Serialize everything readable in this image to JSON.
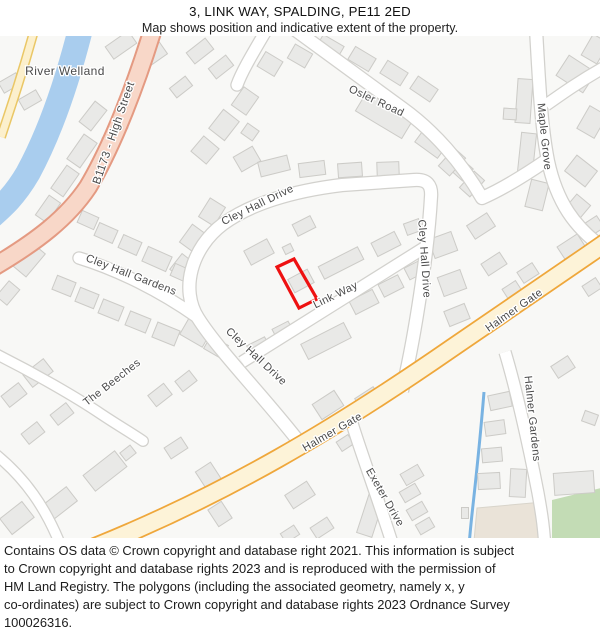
{
  "header": {
    "title": "3, LINK WAY, SPALDING, PE11 2ED",
    "subtitle": "Map shows position and indicative extent of the property."
  },
  "footer": {
    "lines": [
      "Contains OS data © Crown copyright and database right 2021. This information is subject",
      "to Crown copyright and database rights 2023 and is reproduced with the permission of",
      "HM Land Registry. The polygons (including the associated geometry, namely x, y",
      "co-ordinates) are subject to Crown copyright and database rights 2023 Ordnance Survey",
      "100026316."
    ]
  },
  "property": {
    "address": "3, LINK WAY, SPALDING, PE11 2ED",
    "polygon_points": "277,266 294,258 317,298 299,307",
    "outline_color": "#ee1111"
  },
  "map": {
    "colors": {
      "bg": "#f8f8f6",
      "river": "#a9cdee",
      "stream": "#79b3e2",
      "casing": "#d2d1cd",
      "aroadc": "#e49a82",
      "aroadf": "#f8d7c8",
      "yroadc": "#eac766",
      "yroadf": "#fcf0cd",
      "halmerc": "#efa73b",
      "halmerf": "#fdf3d8",
      "bld": "#e9e9e7",
      "blds": "#cccbc7",
      "green": "#c3dcb5",
      "tan": "#eae3d8",
      "label": "#4a4a4a",
      "red": "#ee1111"
    },
    "street_labels": [
      {
        "text": "River Welland",
        "x": 65,
        "y": 74,
        "r": 0,
        "size": 12
      },
      {
        "text": "B1173 - High Street",
        "x": 117,
        "y": 133,
        "r": -71,
        "size": 11.5
      },
      {
        "text": "Osler Road",
        "x": 375,
        "y": 103,
        "r": 25,
        "size": 11
      },
      {
        "text": "Maple Grove",
        "x": 541,
        "y": 136,
        "r": 84,
        "size": 11
      },
      {
        "text": "Cley Hall Drive",
        "x": 259,
        "y": 207,
        "r": -26,
        "size": 11
      },
      {
        "text": "Cley Hall Drive",
        "x": 421,
        "y": 258,
        "r": 86,
        "size": 11
      },
      {
        "text": "Cley Hall Drive",
        "x": 254,
        "y": 358,
        "r": 43,
        "size": 11
      },
      {
        "text": "Cley Hall Gardens",
        "x": 130,
        "y": 277,
        "r": 21,
        "size": 11
      },
      {
        "text": "Link Way",
        "x": 337,
        "y": 297,
        "r": -26,
        "size": 11
      },
      {
        "text": "Halmer Gate",
        "x": 334,
        "y": 434,
        "r": -30,
        "size": 11
      },
      {
        "text": "Halmer Gate",
        "x": 516,
        "y": 312,
        "r": -35,
        "size": 11
      },
      {
        "text": "The Beeches",
        "x": 114,
        "y": 384,
        "r": -38,
        "size": 11
      },
      {
        "text": "Exeter Drive",
        "x": 382,
        "y": 498,
        "r": 60,
        "size": 11
      },
      {
        "text": "Halmer Gardens",
        "x": 529,
        "y": 418,
        "r": 84,
        "size": 11
      }
    ],
    "buildings": [
      [
        10,
        82,
        20,
        12,
        -30
      ],
      [
        30,
        99,
        20,
        12,
        -30
      ],
      [
        121,
        44,
        28,
        15,
        -35
      ],
      [
        152,
        55,
        28,
        14,
        -35
      ],
      [
        93,
        115,
        26,
        15,
        -52
      ],
      [
        115,
        132,
        24,
        14,
        -52
      ],
      [
        200,
        50,
        24,
        14,
        -38
      ],
      [
        221,
        66,
        22,
        13,
        -38
      ],
      [
        181,
        86,
        20,
        12,
        -38
      ],
      [
        82,
        150,
        30,
        16,
        -55
      ],
      [
        65,
        180,
        28,
        15,
        -55
      ],
      [
        48,
        208,
        24,
        14,
        -55
      ],
      [
        28,
        258,
        30,
        20,
        -50
      ],
      [
        8,
        292,
        20,
        14,
        -50
      ],
      [
        300,
        55,
        20,
        16,
        30
      ],
      [
        270,
        63,
        20,
        17,
        31
      ],
      [
        330,
        46,
        24,
        15,
        30
      ],
      [
        362,
        58,
        24,
        15,
        31
      ],
      [
        394,
        72,
        24,
        15,
        32
      ],
      [
        424,
        88,
        24,
        15,
        34
      ],
      [
        385,
        113,
        54,
        25,
        31
      ],
      [
        432,
        141,
        28,
        20,
        36
      ],
      [
        459,
        166,
        24,
        16,
        42
      ],
      [
        245,
        100,
        18,
        22,
        35
      ],
      [
        224,
        124,
        20,
        24,
        38
      ],
      [
        205,
        149,
        20,
        20,
        40
      ],
      [
        250,
        131,
        14,
        12,
        35
      ],
      [
        524,
        100,
        15,
        44,
        4
      ],
      [
        510,
        113,
        13,
        11,
        4
      ],
      [
        527,
        152,
        15,
        40,
        6
      ],
      [
        537,
        194,
        18,
        28,
        14
      ],
      [
        576,
        73,
        32,
        24,
        33
      ],
      [
        592,
        121,
        20,
        26,
        30
      ],
      [
        581,
        170,
        26,
        20,
        38
      ],
      [
        576,
        208,
        24,
        18,
        -50
      ],
      [
        595,
        48,
        18,
        24,
        30
      ],
      [
        247,
        158,
        22,
        17,
        -30
      ],
      [
        274,
        165,
        30,
        15,
        -14
      ],
      [
        312,
        168,
        26,
        14,
        -7
      ],
      [
        350,
        169,
        24,
        14,
        -4
      ],
      [
        388,
        168,
        22,
        14,
        -2
      ],
      [
        452,
        161,
        24,
        15,
        -48
      ],
      [
        472,
        183,
        22,
        14,
        -48
      ],
      [
        259,
        251,
        26,
        16,
        -28
      ],
      [
        301,
        280,
        22,
        15,
        -28
      ],
      [
        288,
        248,
        9,
        8,
        -26
      ],
      [
        212,
        211,
        18,
        22,
        32
      ],
      [
        194,
        238,
        20,
        22,
        36
      ],
      [
        183,
        266,
        18,
        20,
        38
      ],
      [
        341,
        262,
        44,
        14,
        -27
      ],
      [
        386,
        243,
        26,
        15,
        -27
      ],
      [
        413,
        226,
        16,
        12,
        -20
      ],
      [
        304,
        225,
        20,
        13,
        -27
      ],
      [
        326,
        340,
        48,
        17,
        -27
      ],
      [
        283,
        330,
        18,
        13,
        -27
      ],
      [
        259,
        347,
        20,
        15,
        -27
      ],
      [
        364,
        301,
        26,
        15,
        -27
      ],
      [
        391,
        285,
        22,
        14,
        -27
      ],
      [
        415,
        269,
        18,
        13,
        -27
      ],
      [
        88,
        219,
        18,
        13,
        24
      ],
      [
        106,
        232,
        20,
        14,
        24
      ],
      [
        130,
        244,
        20,
        14,
        24
      ],
      [
        157,
        258,
        26,
        16,
        24
      ],
      [
        181,
        272,
        18,
        13,
        24
      ],
      [
        64,
        285,
        20,
        15,
        22
      ],
      [
        87,
        297,
        20,
        15,
        22
      ],
      [
        111,
        309,
        22,
        15,
        22
      ],
      [
        138,
        321,
        22,
        15,
        22
      ],
      [
        166,
        333,
        24,
        16,
        22
      ],
      [
        196,
        331,
        26,
        20,
        30
      ],
      [
        216,
        346,
        20,
        15,
        30
      ],
      [
        38,
        372,
        26,
        16,
        -38
      ],
      [
        14,
        394,
        22,
        14,
        -38
      ],
      [
        62,
        413,
        20,
        13,
        -38
      ],
      [
        105,
        470,
        40,
        20,
        -38
      ],
      [
        60,
        502,
        30,
        18,
        -38
      ],
      [
        17,
        517,
        28,
        20,
        -38
      ],
      [
        33,
        432,
        20,
        13,
        -38
      ],
      [
        160,
        394,
        20,
        14,
        -38
      ],
      [
        186,
        380,
        18,
        13,
        -38
      ],
      [
        128,
        452,
        13,
        10,
        -38
      ],
      [
        210,
        477,
        18,
        26,
        -33
      ],
      [
        220,
        513,
        16,
        20,
        -33
      ],
      [
        176,
        447,
        20,
        13,
        -33
      ],
      [
        443,
        244,
        24,
        20,
        -20
      ],
      [
        452,
        282,
        24,
        20,
        -20
      ],
      [
        457,
        314,
        22,
        16,
        -22
      ],
      [
        465,
        337,
        20,
        13,
        -27
      ],
      [
        481,
        225,
        24,
        16,
        -33
      ],
      [
        494,
        263,
        22,
        14,
        -33
      ],
      [
        512,
        289,
        16,
        12,
        -33
      ],
      [
        528,
        272,
        18,
        13,
        -33
      ],
      [
        572,
        247,
        24,
        18,
        -33
      ],
      [
        592,
        226,
        20,
        14,
        -33
      ],
      [
        592,
        286,
        16,
        12,
        -33
      ],
      [
        563,
        366,
        20,
        14,
        -33
      ],
      [
        328,
        404,
        26,
        18,
        -33
      ],
      [
        368,
        398,
        22,
        15,
        -33
      ],
      [
        300,
        494,
        26,
        16,
        -33
      ],
      [
        322,
        527,
        20,
        13,
        -33
      ],
      [
        290,
        533,
        16,
        11,
        -33
      ],
      [
        412,
        474,
        20,
        13,
        -30
      ],
      [
        410,
        492,
        18,
        12,
        -30
      ],
      [
        417,
        510,
        18,
        12,
        -30
      ],
      [
        425,
        525,
        16,
        11,
        -30
      ],
      [
        371,
        513,
        16,
        44,
        18
      ],
      [
        500,
        400,
        22,
        15,
        -12
      ],
      [
        495,
        427,
        20,
        14,
        -8
      ],
      [
        492,
        454,
        20,
        14,
        -5
      ],
      [
        489,
        480,
        22,
        16,
        -3
      ],
      [
        518,
        482,
        16,
        28,
        3
      ],
      [
        574,
        482,
        40,
        22,
        -4
      ],
      [
        590,
        417,
        14,
        11,
        20
      ],
      [
        465,
        512,
        7,
        11,
        0
      ],
      [
        345,
        442,
        14,
        11,
        -33
      ]
    ]
  }
}
